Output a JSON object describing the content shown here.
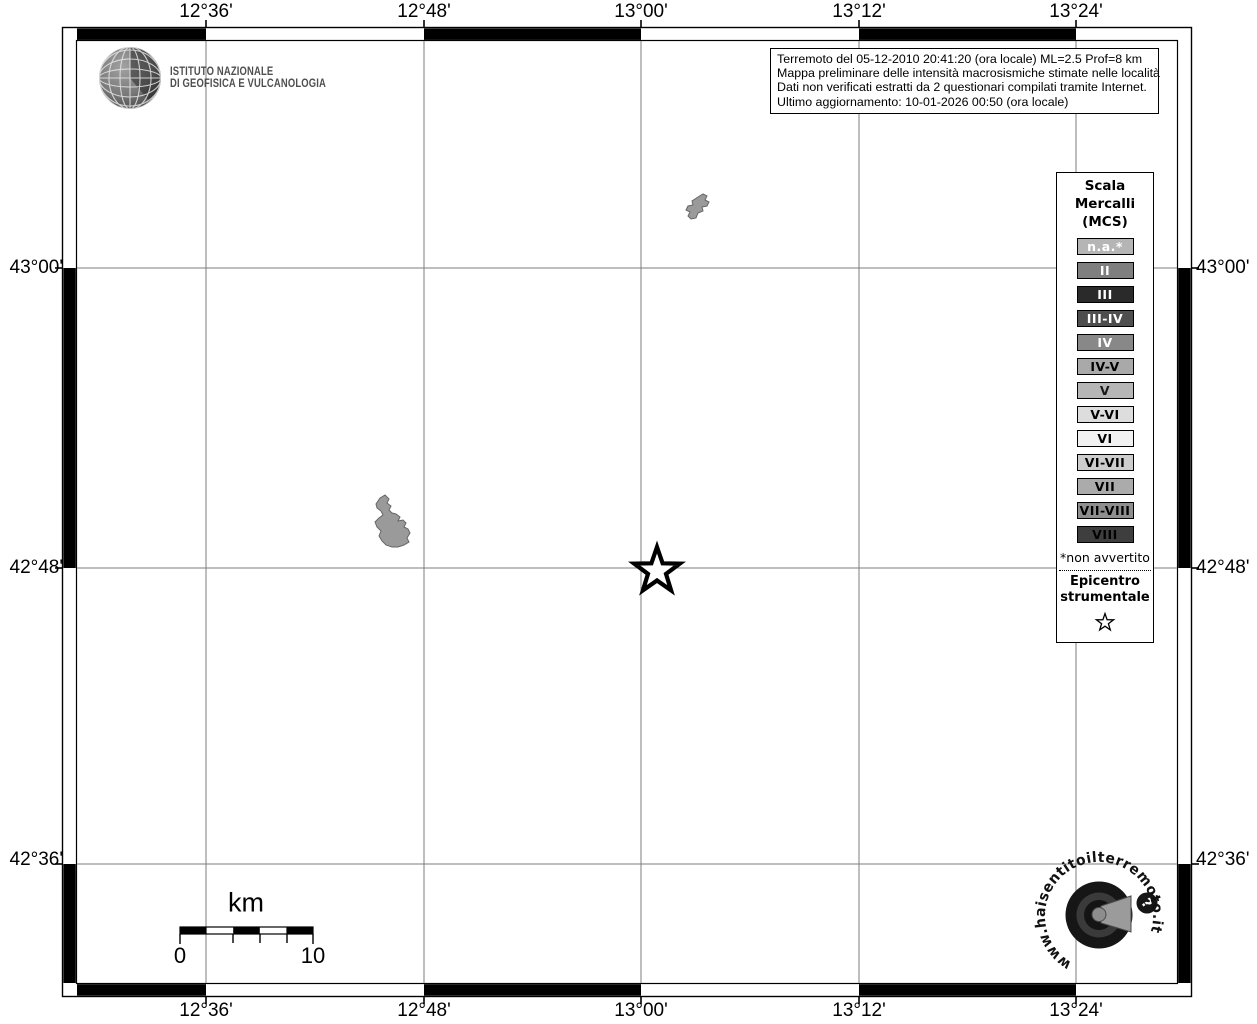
{
  "map": {
    "longitude_ticks": [
      "12°36'",
      "12°48'",
      "13°00'",
      "13°12'",
      "13°24'"
    ],
    "latitude_ticks": [
      "43°00'",
      "42°48'",
      "42°36'"
    ],
    "epicenter_marker": "star",
    "features": [
      "lake-outline",
      "lake-outline"
    ]
  },
  "header": {
    "ingv_logo": {
      "line1": "ISTITUTO NAZIONALE",
      "line2": "DI GEOFISICA E VULCANOLOGIA"
    },
    "info_box": {
      "lines": [
        "Terremoto del 05-12-2010 20:41:20 (ora locale) ML=2.5 Prof=8 km",
        "Mappa preliminare delle intensità macrosismiche stimate nelle località",
        "Dati non verificati estratti da 2 questionari compilati tramite Internet.",
        "Ultimo aggiornamento: 10-01-2026 00:50 (ora locale)"
      ]
    }
  },
  "legend": {
    "title_lines": [
      "Scala",
      "Mercalli",
      "(MCS)"
    ],
    "items": [
      {
        "label": "n.a.*",
        "bg": "#b5b5b5",
        "fg": "#ffffff"
      },
      {
        "label": "II",
        "bg": "#7f7f7f",
        "fg": "#ffffff"
      },
      {
        "label": "III",
        "bg": "#2a2a2a",
        "fg": "#ffffff"
      },
      {
        "label": "III-IV",
        "bg": "#4e4e4e",
        "fg": "#ffffff"
      },
      {
        "label": "IV",
        "bg": "#888888",
        "fg": "#ffffff"
      },
      {
        "label": "IV-V",
        "bg": "#a9a9a9",
        "fg": "#000000"
      },
      {
        "label": "V",
        "bg": "#b6b6b6",
        "fg": "#1a1a1a"
      },
      {
        "label": "V-VI",
        "bg": "#dddddd",
        "fg": "#000000"
      },
      {
        "label": "VI",
        "bg": "#f1f1f1",
        "fg": "#000000"
      },
      {
        "label": "VI-VII",
        "bg": "#cdcdcd",
        "fg": "#000000"
      },
      {
        "label": "VII",
        "bg": "#ababab",
        "fg": "#000000"
      },
      {
        "label": "VII-VIII",
        "bg": "#8e8e8e",
        "fg": "#000000"
      },
      {
        "label": "VIII",
        "bg": "#3e3e3e",
        "fg": "#000000"
      }
    ],
    "footnote": "*non avvertito",
    "epicenter_label_lines": [
      "Epicentro",
      "strumentale"
    ]
  },
  "scale_bar": {
    "unit": "km",
    "start": "0",
    "end": "10"
  },
  "watermark": {
    "text": "www.haisentitoilterremoto.it",
    "badge": "?"
  },
  "colors": {
    "frame": "#000000",
    "grid": "#7d7d7d",
    "water_fill": "#9a9a9a",
    "water_stroke": "#666666"
  }
}
